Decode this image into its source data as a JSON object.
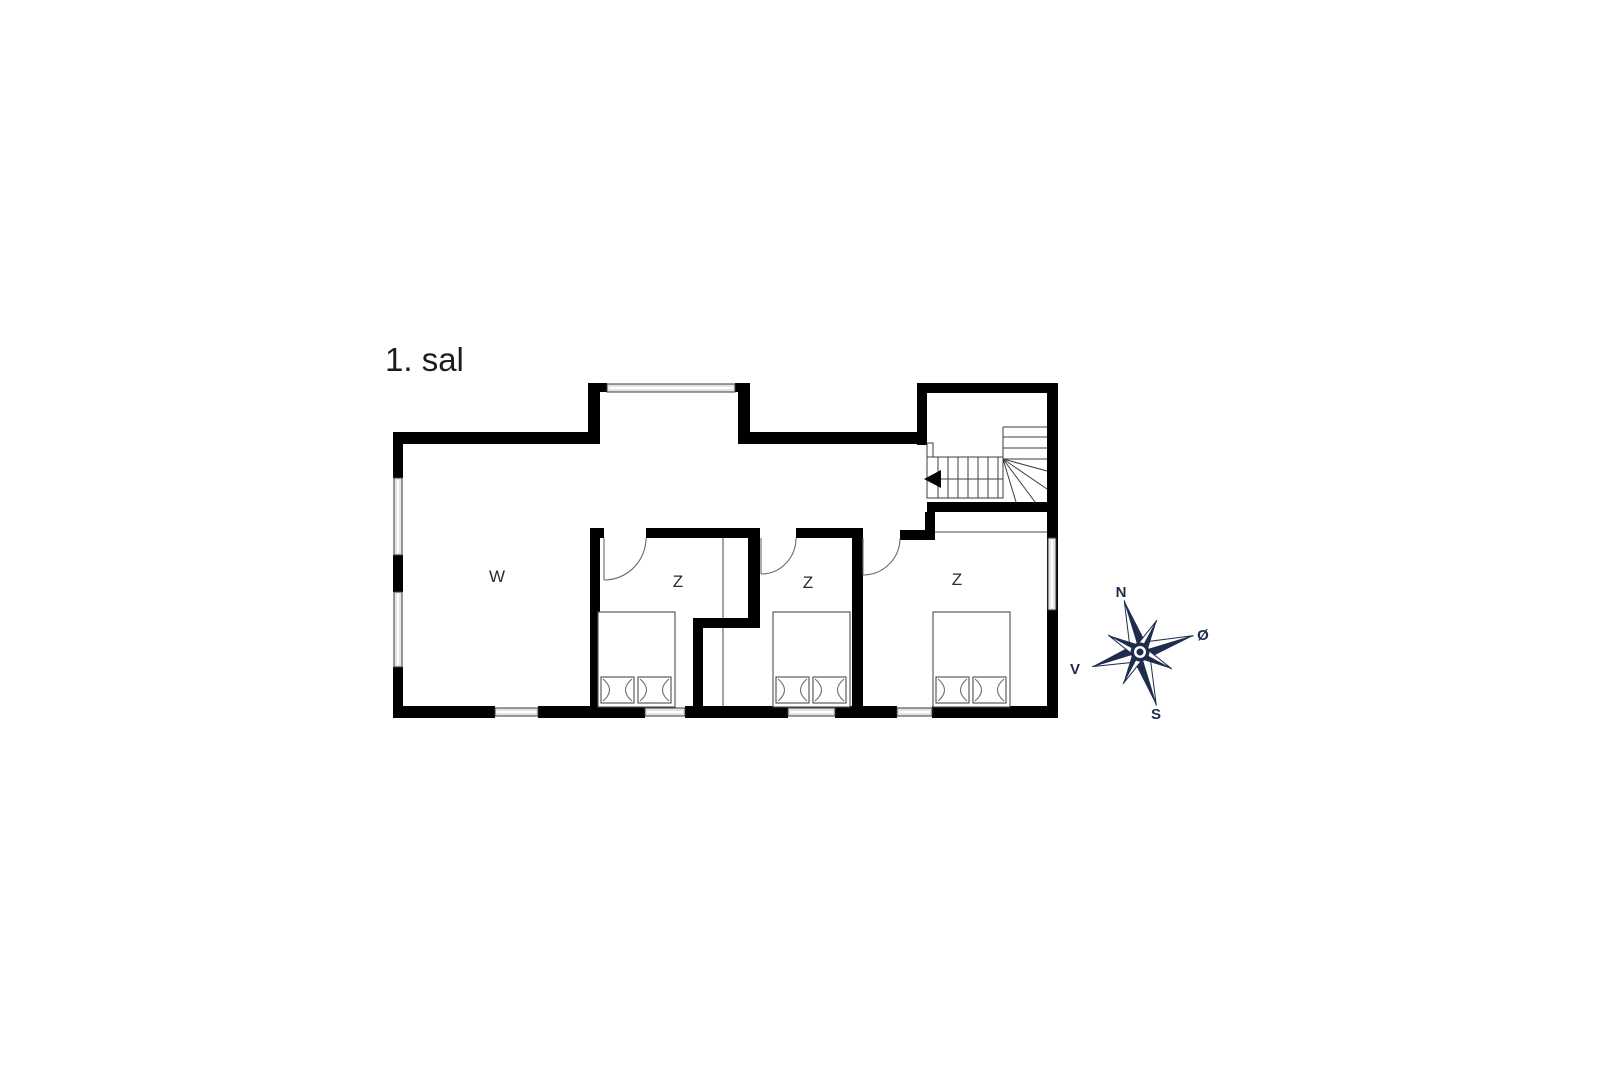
{
  "title": "1. sal",
  "rooms": [
    {
      "id": "living",
      "label": "W"
    },
    {
      "id": "bedroom-1",
      "label": "Z"
    },
    {
      "id": "bedroom-2",
      "label": "Z"
    },
    {
      "id": "bedroom-3",
      "label": "Z"
    }
  ],
  "compass": {
    "north": "N",
    "east": "Ø",
    "south": "S",
    "west": "V"
  },
  "colors": {
    "wall": "#010101",
    "compass": "#1f2d4d",
    "window_fill": "#e4e4e4"
  }
}
